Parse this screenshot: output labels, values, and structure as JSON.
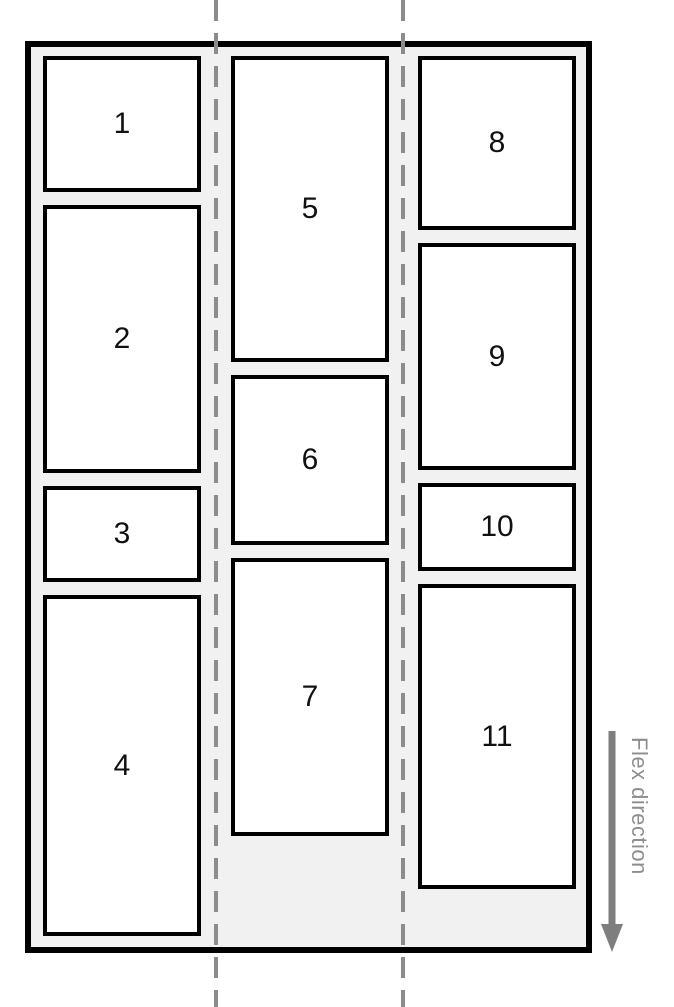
{
  "columns": [
    {
      "items": [
        {
          "label": "1"
        },
        {
          "label": "2"
        },
        {
          "label": "3"
        },
        {
          "label": "4"
        }
      ]
    },
    {
      "items": [
        {
          "label": "5"
        },
        {
          "label": "6"
        },
        {
          "label": "7"
        }
      ]
    },
    {
      "items": [
        {
          "label": "8"
        },
        {
          "label": "9"
        },
        {
          "label": "10"
        },
        {
          "label": "11"
        }
      ]
    }
  ],
  "flex_direction_label": "Flex direction",
  "colors": {
    "container_background": "#f1f1f1",
    "item_background": "#ffffff",
    "border": "#000000",
    "guide_line": "#8c8c8c",
    "arrow": "#7e7e7e",
    "annotation_text": "#8e8e8e"
  }
}
